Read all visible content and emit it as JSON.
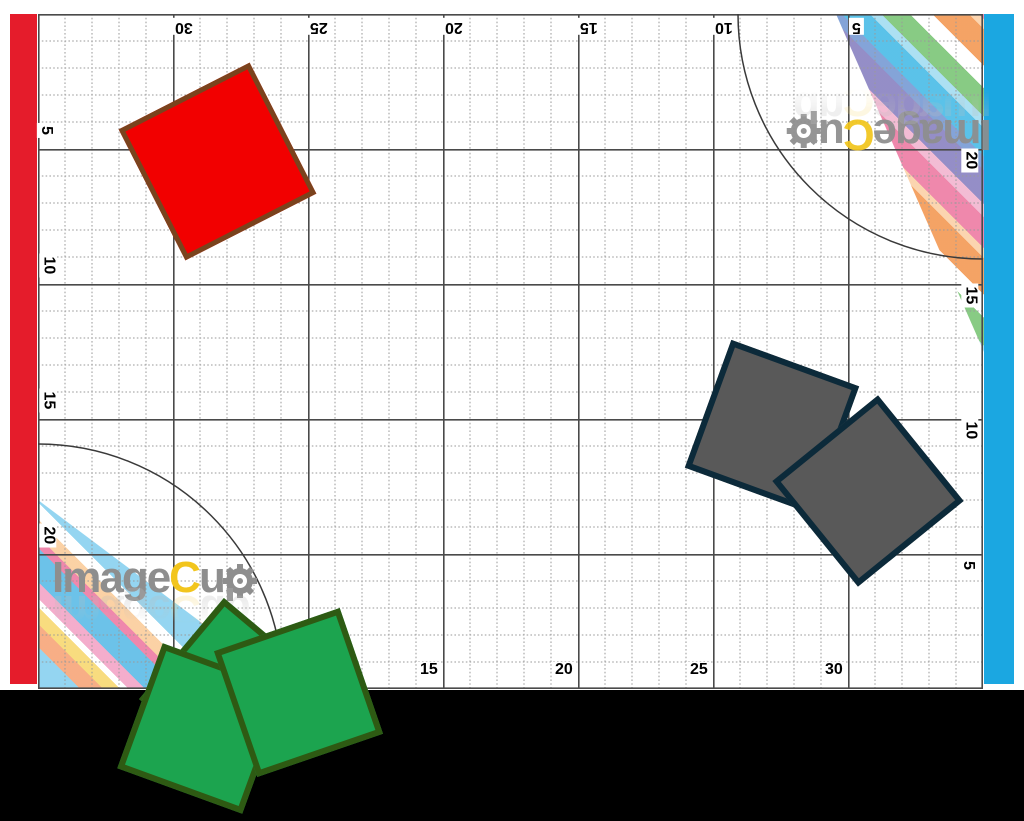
{
  "mat": {
    "rulers": {
      "top": [
        "30",
        "25",
        "20",
        "15",
        "10",
        "5"
      ],
      "bottom": [
        "15",
        "20",
        "25",
        "30"
      ],
      "left": [
        "5",
        "10",
        "15",
        "20"
      ],
      "right": [
        "20",
        "15",
        "10",
        "5"
      ]
    },
    "colors": {
      "left_edge_strip": "#E51C2B",
      "right_edge_strip": "#1BA7E1",
      "grid_minor": "#9A9A9A",
      "grid_major": "#4A4A4A",
      "arc_line": "#3A3A3A",
      "label_text": "#3A3A3A"
    },
    "logo": {
      "part1": "Image",
      "part2": "C",
      "part3": "u",
      "part4": "p",
      "text_color": "#8E8E8E",
      "accent_color": "#F2C51D"
    }
  },
  "pieces": {
    "red_square": {
      "fill": "#F20000",
      "border": "#7A431D"
    },
    "gray_square_left": {
      "fill": "#595959",
      "border": "#0C2A3A"
    },
    "gray_square_right": {
      "fill": "#595959",
      "border": "#0C2A3A"
    },
    "green_square_back": {
      "fill": "#1CA44F",
      "border": "#2E5A13"
    },
    "green_square_middle": {
      "fill": "#1CA44F",
      "border": "#2E5A13"
    },
    "green_square_front": {
      "fill": "#1CA44F",
      "border": "#2E5A13"
    }
  }
}
